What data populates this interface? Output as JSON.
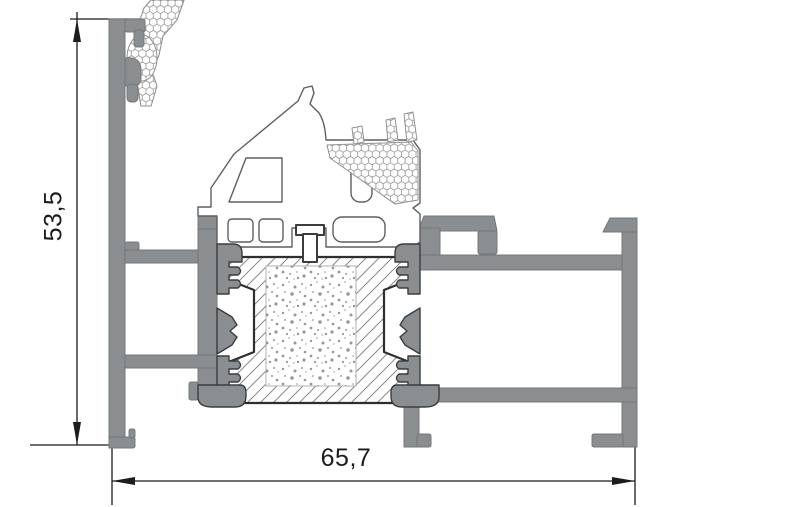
{
  "drawing": {
    "kind": "profile-cross-section",
    "dimensions": {
      "height_label": "53,5",
      "width_label": "65,7"
    },
    "colors": {
      "profile_gray": "#8a8e91",
      "detail_outline": "#2e2e2e",
      "dimension_line": "#1a1a1a",
      "hatch_line": "#8a8a8a",
      "background": "#ffffff"
    }
  }
}
